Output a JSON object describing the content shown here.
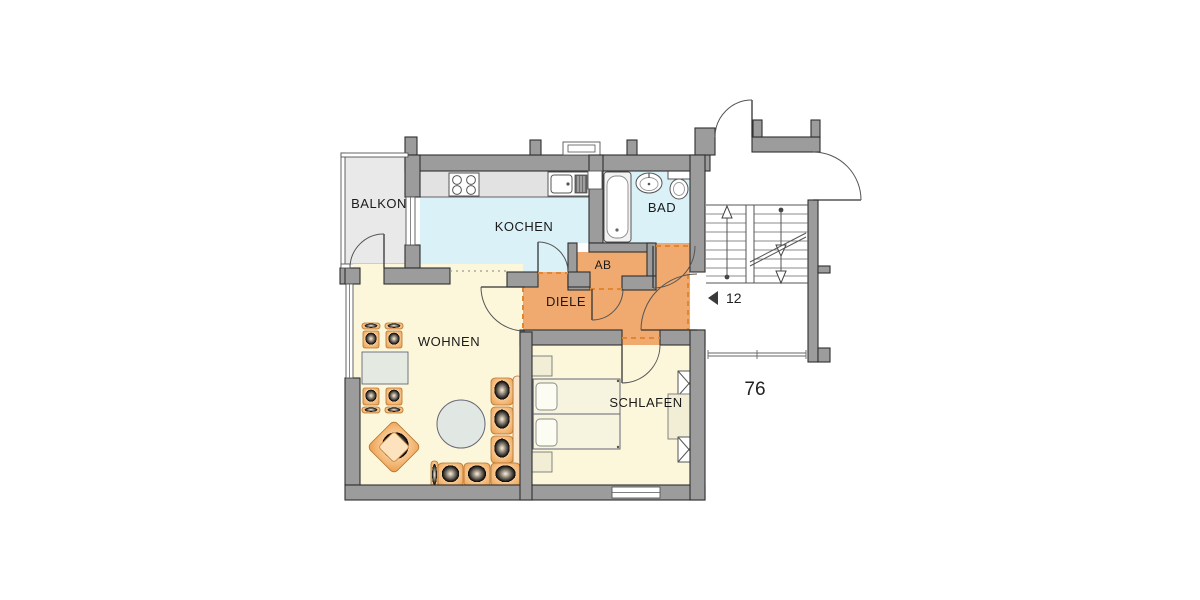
{
  "plan_title": "apartment-floor-plan",
  "rooms": {
    "balkon": {
      "label": "BALKON"
    },
    "kochen": {
      "label": "KOCHEN"
    },
    "bad": {
      "label": "BAD"
    },
    "ab": {
      "label": "AB"
    },
    "diele": {
      "label": "DIELE"
    },
    "wohnen": {
      "label": "WOHNEN"
    },
    "schlafen": {
      "label": "SCHLAFEN"
    }
  },
  "annotations": {
    "apartment_number": "12",
    "area_number": "76"
  },
  "colors": {
    "wall": "#9c9c9c",
    "wall-outline": "#2f2f2f",
    "floor-living": "#fcf7da",
    "floor-wet": "#d9f1f7",
    "floor-hall": "#f0a96e",
    "floor-balcony": "#e9e9e9",
    "furniture-accent": "#f2a55e",
    "diele-dash": "#e2872f"
  }
}
